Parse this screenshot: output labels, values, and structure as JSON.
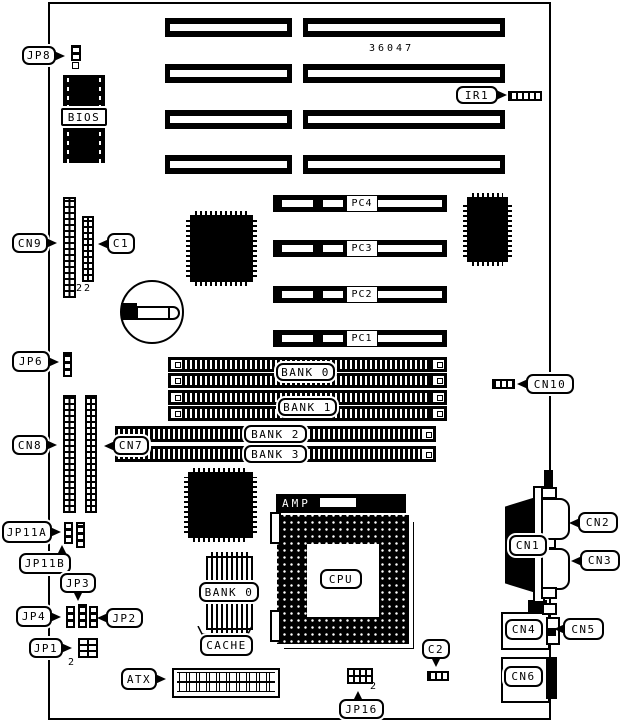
{
  "diagram": {
    "board_number": "36047",
    "callouts": {
      "jp8": "JP8",
      "bios": "BIOS",
      "cn9": "CN9",
      "c1": "C1",
      "jp6": "JP6",
      "cn8": "CN8",
      "cn7": "CN7",
      "jp11a": "JP11A",
      "jp11b": "JP11B",
      "jp3": "JP3",
      "jp4": "JP4",
      "jp2": "JP2",
      "jp1": "JP1",
      "atx": "ATX",
      "ir1": "IR1",
      "cn10": "CN10",
      "c2": "C2",
      "jp16": "JP16",
      "cn1": "CN1",
      "cn2": "CN2",
      "cn3": "CN3",
      "cn4": "CN4",
      "cn5": "CN5",
      "cn6": "CN6",
      "cpu": "CPU",
      "amp": "AMP",
      "cache": "CACHE",
      "cache_bank": "BANK 0"
    },
    "pin_numbers": {
      "c1_pin": "22",
      "jp1_pin": "2",
      "jp16_pin": "2"
    },
    "pci_slots": [
      {
        "label": "PC4"
      },
      {
        "label": "PC3"
      },
      {
        "label": "PC2"
      },
      {
        "label": "PC1"
      }
    ],
    "memory_banks": [
      {
        "label": "BANK 0"
      },
      {
        "label": "BANK 1"
      },
      {
        "label": "BANK 2"
      },
      {
        "label": "BANK 3"
      }
    ]
  }
}
